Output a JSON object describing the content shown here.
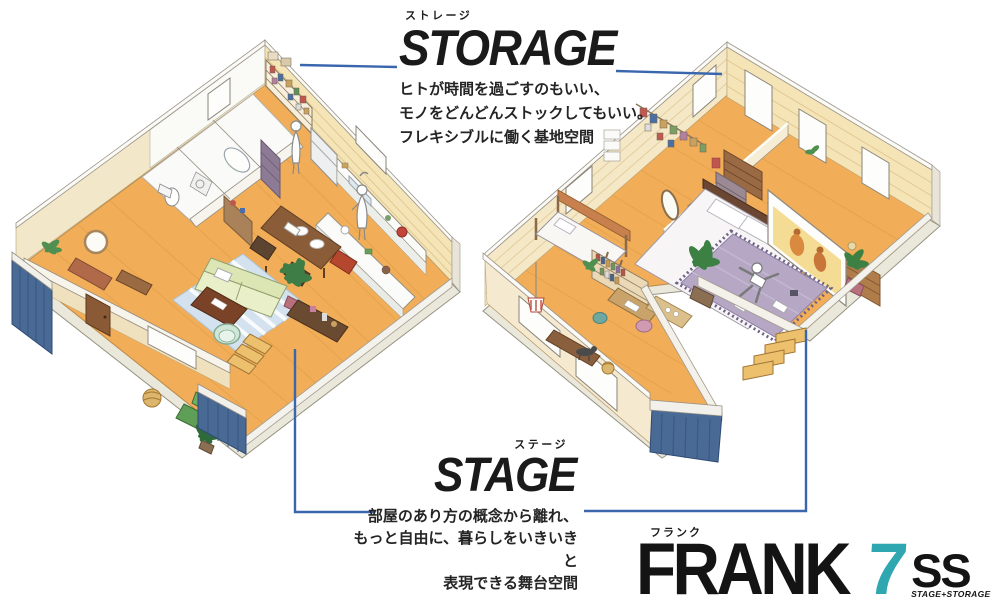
{
  "storage_label": {
    "kana": "ストレージ",
    "title": "STORAGE",
    "desc_lines": [
      "ヒトが時間を過ごすのもいい、",
      "モノをどんどんストックしてもいい。",
      "フレキシブルに働く基地空間"
    ]
  },
  "stage_label": {
    "kana": "ステージ",
    "title": "STAGE",
    "desc_lines": [
      "部屋のあり方の概念から離れ、",
      "もっと自由に、暮らしをいきいきと",
      "表現できる舞台空間"
    ]
  },
  "logo": {
    "kana": "フランク",
    "brand": "FRANK",
    "number": "7",
    "suffix": "SS",
    "tagline": "STAGE+STORAGE"
  },
  "colors": {
    "accent_teal": "#2fa7b0",
    "connector_blue": "#3a66ad",
    "navy_wall": "#4a6a96",
    "wood_floor": "#f1ad58",
    "wall_cream": "#f4e4b6",
    "title_black": "#1a1a1a"
  }
}
